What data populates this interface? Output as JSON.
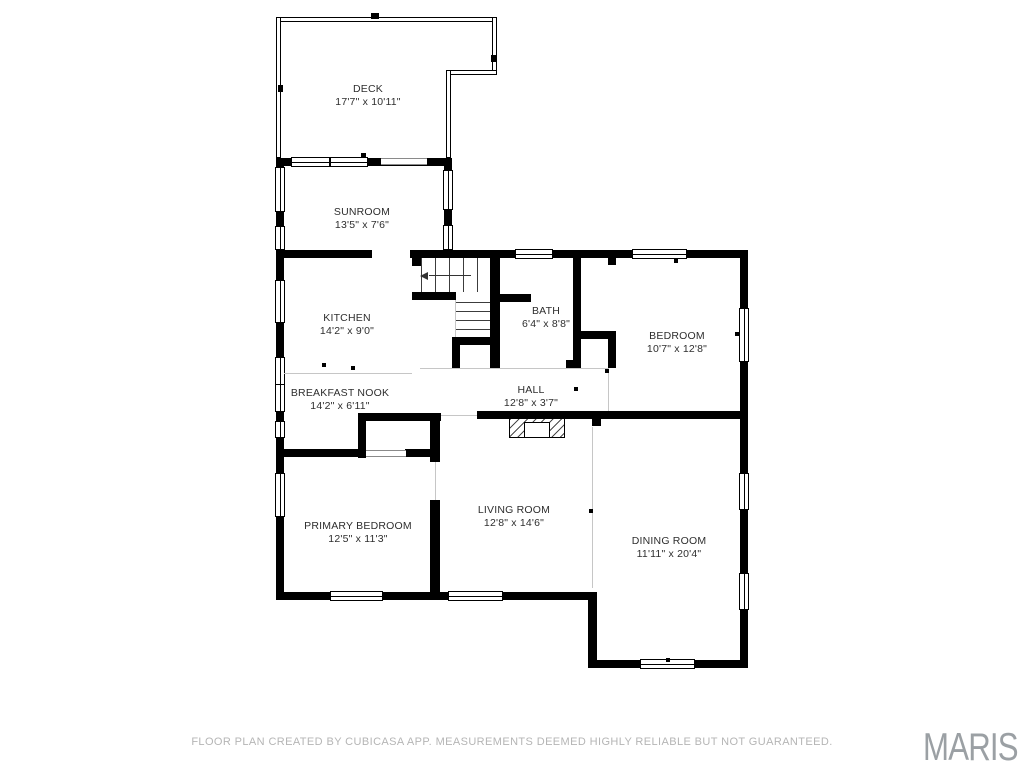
{
  "floor_plan": {
    "rooms": [
      {
        "id": "deck",
        "name": "DECK",
        "dims": "17'7\" x 10'11\""
      },
      {
        "id": "sunroom",
        "name": "SUNROOM",
        "dims": "13'5\" x 7'6\""
      },
      {
        "id": "kitchen",
        "name": "KITCHEN",
        "dims": "14'2\" x 9'0\""
      },
      {
        "id": "bath",
        "name": "BATH",
        "dims": "6'4\" x 8'8\""
      },
      {
        "id": "bedroom",
        "name": "BEDROOM",
        "dims": "10'7\" x 12'8\""
      },
      {
        "id": "breakfast-nook",
        "name": "BREAKFAST NOOK",
        "dims": "14'2\" x 6'11\""
      },
      {
        "id": "hall",
        "name": "HALL",
        "dims": "12'8\" x 3'7\""
      },
      {
        "id": "primary-bedroom",
        "name": "PRIMARY BEDROOM",
        "dims": "12'5\" x 11'3\""
      },
      {
        "id": "living-room",
        "name": "LIVING ROOM",
        "dims": "12'8\" x 14'6\""
      },
      {
        "id": "dining-room",
        "name": "DINING ROOM",
        "dims": "11'11\" x 20'4\""
      }
    ]
  },
  "footer": {
    "disclaimer": "FLOOR PLAN CREATED BY CUBICASA APP. MEASUREMENTS DEEMED HIGHLY RELIABLE BUT NOT GUARANTEED.",
    "logo": "MARIS"
  },
  "colors": {
    "wall": "#000000",
    "label_text": "#2e2e2e",
    "disclaimer_text": "#b5b5b5",
    "logo_text": "#9ba0a4"
  }
}
